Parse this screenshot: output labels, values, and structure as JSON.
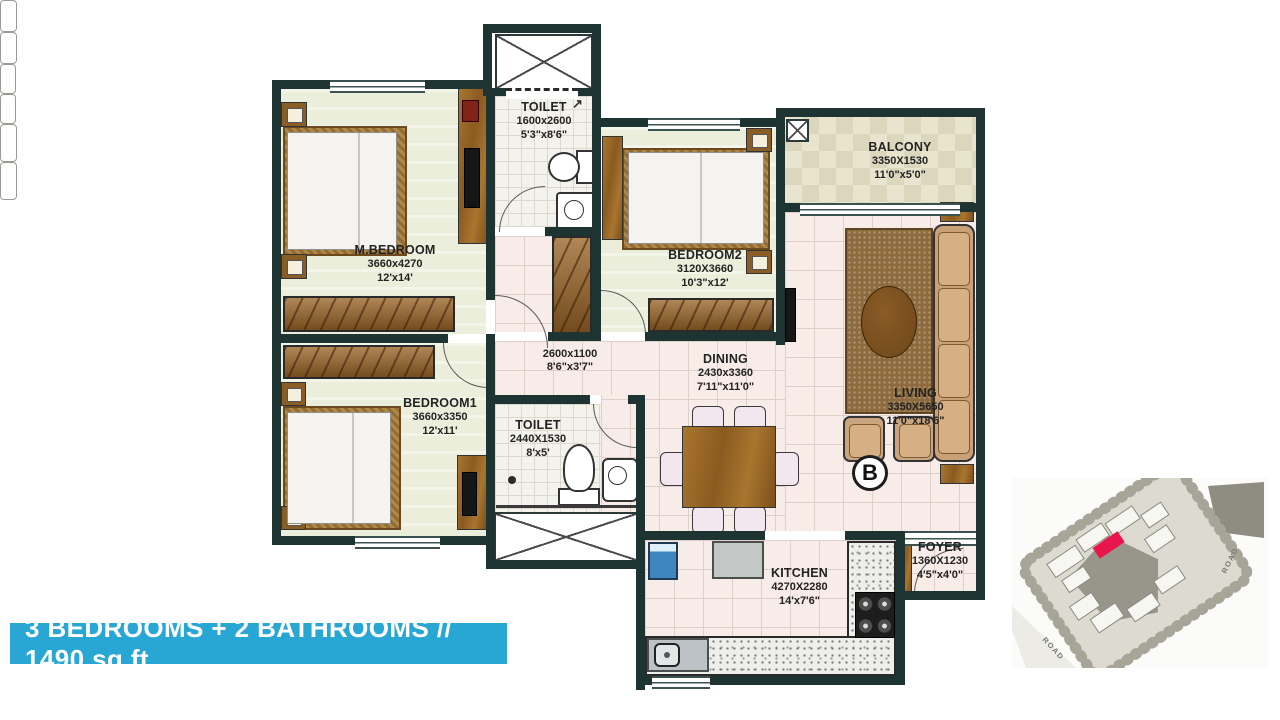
{
  "banner": {
    "text": "3 BEDROOMS + 2 BATHROOMS // 1490 sq.ft",
    "bg_color": "#29a7d4",
    "text_color": "#ffffff"
  },
  "unit_marker": {
    "label": "B"
  },
  "rooms": [
    {
      "id": "toilet-1",
      "name": "TOILET",
      "metric": "1600x2600",
      "imperial": "5'3\"x8'6\""
    },
    {
      "id": "m-bedroom",
      "name": "M.BEDROOM",
      "metric": "3660x4270",
      "imperial": "12'x14'"
    },
    {
      "id": "bedroom-2",
      "name": "BEDROOM2",
      "metric": "3120X3660",
      "imperial": "10'3\"x12'"
    },
    {
      "id": "balcony",
      "name": "BALCONY",
      "metric": "3350X1530",
      "imperial": "11'0\"x5'0\""
    },
    {
      "id": "passage",
      "name": "",
      "metric": "2600x1100",
      "imperial": "8'6\"x3'7\""
    },
    {
      "id": "dining",
      "name": "DINING",
      "metric": "2430x3360",
      "imperial": "7'11\"x11'0\""
    },
    {
      "id": "living",
      "name": "LIVING",
      "metric": "3350X5650",
      "imperial": "11'0\"x18'6\""
    },
    {
      "id": "bedroom-1",
      "name": "BEDROOM1",
      "metric": "3660x3350",
      "imperial": "12'x11'"
    },
    {
      "id": "toilet-2",
      "name": "TOILET",
      "metric": "2440X1530",
      "imperial": "8'x5'"
    },
    {
      "id": "kitchen",
      "name": "KITCHEN",
      "metric": "4270X2280",
      "imperial": "14'x7'6\""
    },
    {
      "id": "foyer",
      "name": "FOYER",
      "metric": "1360X1230",
      "imperial": "4'5\"x4'0\""
    }
  ],
  "icons": {
    "exhaust_arrow": "↗"
  },
  "site_map": {
    "road_labels": [
      "ROAD",
      "ROAD"
    ],
    "marker_color": "#e8174b"
  },
  "colors": {
    "wall": "#1e3432",
    "banner": "#29a7d4",
    "bedroom_floor": "#ebeeda",
    "living_floor": "#f7ece8"
  }
}
